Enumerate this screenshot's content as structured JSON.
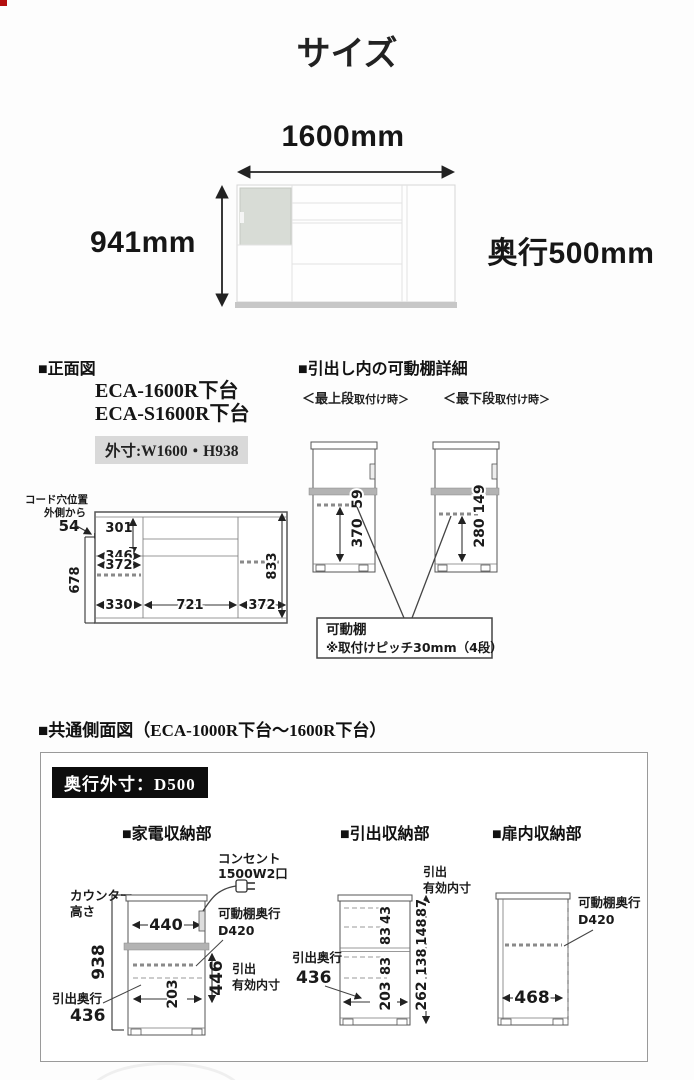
{
  "page": {
    "title": "サイズ"
  },
  "overview": {
    "width": "1600mm",
    "height": "941mm",
    "depth": "奥行500mm"
  },
  "front_view": {
    "header": "■正面図",
    "model_1": "ECA-1600R下台",
    "model_2": "ECA-S1600R下台",
    "outer_dim": "外寸:W1600・H938",
    "cord_note_1": "コード穴位置",
    "cord_note_2": "外側から",
    "cord_value": "54",
    "d_301": "301",
    "d_346": "346",
    "d_372l": "372",
    "d_330": "330",
    "d_721": "721",
    "d_372r": "372",
    "d_678": "678",
    "d_833": "833"
  },
  "shelf_detail": {
    "header": "■引出し内の可動棚詳細",
    "label_top_bold": "＜最上段",
    "label_top_rest": "取付け時＞",
    "label_bottom_bold": "＜最下段",
    "label_bottom_rest": "取付け時＞",
    "top_d_upper": "59",
    "top_d_lower": "370",
    "bottom_d_upper": "149",
    "bottom_d_lower": "280",
    "note_1": "可動棚",
    "note_2": "※取付けピッチ30mm（4段）"
  },
  "side_view": {
    "header": "■共通側面図（ECA-1000R下台～1600R下台）",
    "depth_badge": "奥行外寸：D500",
    "appliance": {
      "header": "■家電収納部",
      "counter_1": "カウンター",
      "counter_2": "高さ",
      "d_938": "938",
      "d_440": "440",
      "outlet_1": "コンセント",
      "outlet_2": "1500W2口",
      "shelf_1": "可動棚奥行",
      "shelf_2": "D420",
      "d_446": "446",
      "inner_1": "引出",
      "inner_2": "有効内寸",
      "drawer_label": "引出奥行",
      "d_436": "436",
      "d_203": "203"
    },
    "drawer": {
      "header": "■引出収納部",
      "inner_1": "引出",
      "inner_2": "有効内寸",
      "drawer_label": "引出奥行",
      "d_436": "436",
      "cell_dims": [
        "43",
        "83",
        "83",
        "203"
      ],
      "right_dims": [
        "87",
        "148",
        "138",
        "262"
      ]
    },
    "door": {
      "header": "■扉内収納部",
      "shelf_1": "可動棚奥行",
      "shelf_2": "D420",
      "d_468": "468"
    }
  }
}
